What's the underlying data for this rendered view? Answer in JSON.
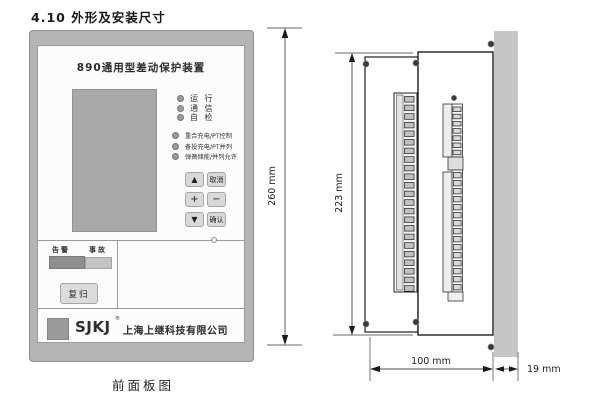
{
  "document": {
    "section_title": "4.10 外形及安装尺寸",
    "figure_caption": "前面板图"
  },
  "front_panel": {
    "device_title": "890通用型差动保护装置",
    "status_leds": [
      {
        "label": "运 行"
      },
      {
        "label": "通 信"
      },
      {
        "label": "自 检"
      }
    ],
    "function_leds": [
      {
        "label": "重合充电/PT控制"
      },
      {
        "label": "备投充电/PT并列"
      },
      {
        "label": "弹簧储能/并列允许"
      }
    ],
    "keypad": [
      {
        "label": "▲"
      },
      {
        "label": "取消"
      },
      {
        "label": "+"
      },
      {
        "label": "−"
      },
      {
        "label": "▼"
      },
      {
        "label": "确认"
      }
    ],
    "alarm_label": "告警",
    "fault_label": "事故",
    "reset_button_label": "复归",
    "brand": {
      "logo_abbr": "SJKJ",
      "reg_mark": "®",
      "company_name": "上海上继科技有限公司"
    }
  },
  "side_view": {
    "dimensions": {
      "front_height": "260 mm",
      "case_height": "223 mm",
      "case_depth": "100 mm",
      "front_depth": "19 mm"
    },
    "terminals": {
      "left_count": 23,
      "right_upper_count": 7,
      "right_lower_count": 15
    }
  },
  "colors": {
    "bezel": "#b5b5b5",
    "lcd": "#a9a9a9",
    "alarm_block": "#8f8f8f",
    "fault_block": "#c3c3c3",
    "button_face": "#d9d9d9",
    "mount_panel": "#c6c6c6"
  }
}
